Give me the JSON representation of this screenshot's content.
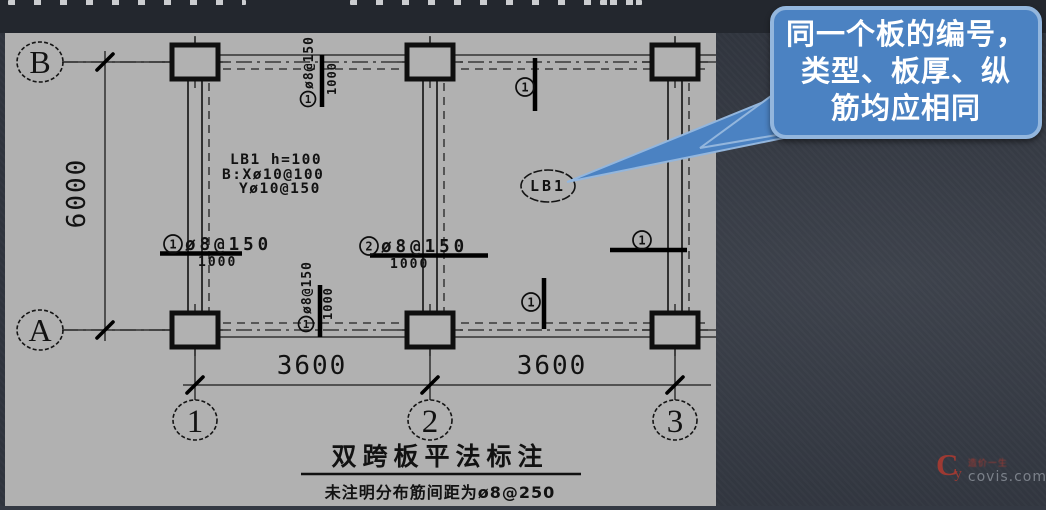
{
  "slide": {
    "callout": {
      "lines": [
        "同一个板的编号，",
        "类型、板厚、纵",
        "筋均应相同"
      ],
      "fill_color": "#4b82c2",
      "border_color": "#93b6dd",
      "text_color": "#ffffff"
    }
  },
  "drawing": {
    "title": "双跨板平法标注",
    "note": "未注明分布筋间距为ø8@250",
    "axis_bubbles": {
      "row_top": "B",
      "row_bottom": "A",
      "col_left": "1",
      "col_mid": "2",
      "col_right": "3"
    },
    "dimensions": {
      "vertical": "6000",
      "horizontal_left": "3600",
      "horizontal_right": "3600"
    },
    "slab_annotation": {
      "line1": "LB1 h=100",
      "line2": "B:Xø10@100",
      "line3": "Yø10@150"
    },
    "slab_tag": "LB1",
    "rebar": {
      "left": {
        "mark": "1",
        "spec": "ø8@150",
        "extent": "1000"
      },
      "middle": {
        "mark": "2",
        "spec": "ø8@150",
        "extent": "1000"
      },
      "top_span": {
        "mark": "1",
        "spec": "ø8@150",
        "extent": "1000"
      },
      "bottom_span": {
        "mark": "1",
        "spec": "ø8@150",
        "extent": "1000"
      },
      "mark_top_right": "1",
      "mark_bottom_right": "1",
      "mark_right_span": "1"
    }
  },
  "watermark": {
    "logo_main": "C",
    "logo_sub": "y",
    "tagline": "造价一生",
    "site": "covis.com"
  }
}
